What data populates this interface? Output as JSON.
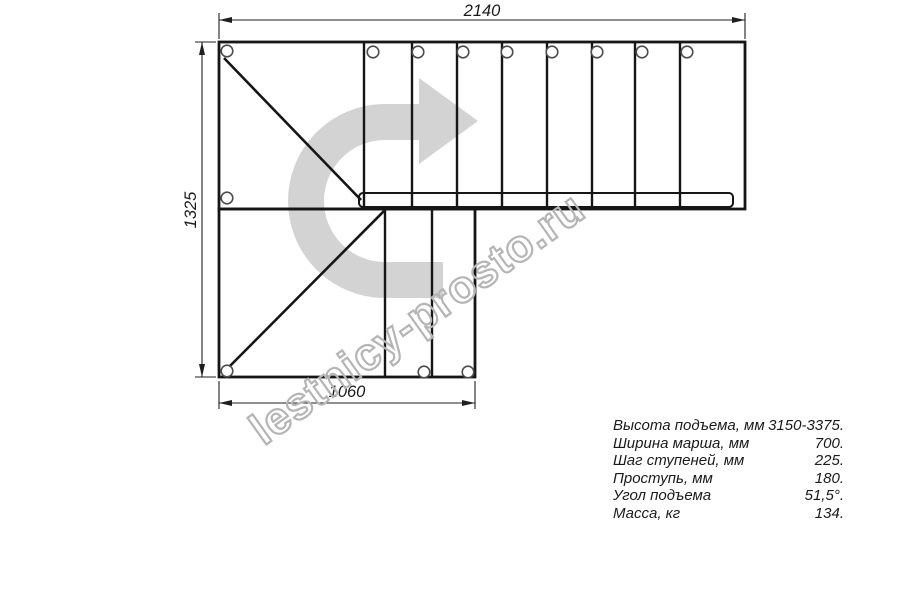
{
  "drawing": {
    "dimensions": {
      "top": "2140",
      "left": "1325",
      "bottom": "1060"
    },
    "watermark_text": "lestnicy-prosto.ru",
    "icons": {
      "direction_arrow": "u-turn-right-thick-arrow",
      "mounting_hole": "small-circle"
    },
    "colors": {
      "line": "#161616",
      "dimension_line": "#1f1f1f",
      "hole_stroke": "#4d4d4d",
      "arrow_fill": "#d3d3d3",
      "watermark_stroke": "#b5b5b5",
      "text": "#1a1a1a"
    }
  },
  "specs": {
    "rows": [
      {
        "label": "Высота подъема, мм",
        "value": "3150-3375."
      },
      {
        "label": "Ширина марша, мм",
        "value": "700."
      },
      {
        "label": "Шаг ступеней, мм",
        "value": "225."
      },
      {
        "label": "Проступь, мм",
        "value": "180."
      },
      {
        "label": "Угол подъема",
        "value": "51,5°."
      },
      {
        "label": "Масса, кг",
        "value": "134."
      }
    ]
  }
}
